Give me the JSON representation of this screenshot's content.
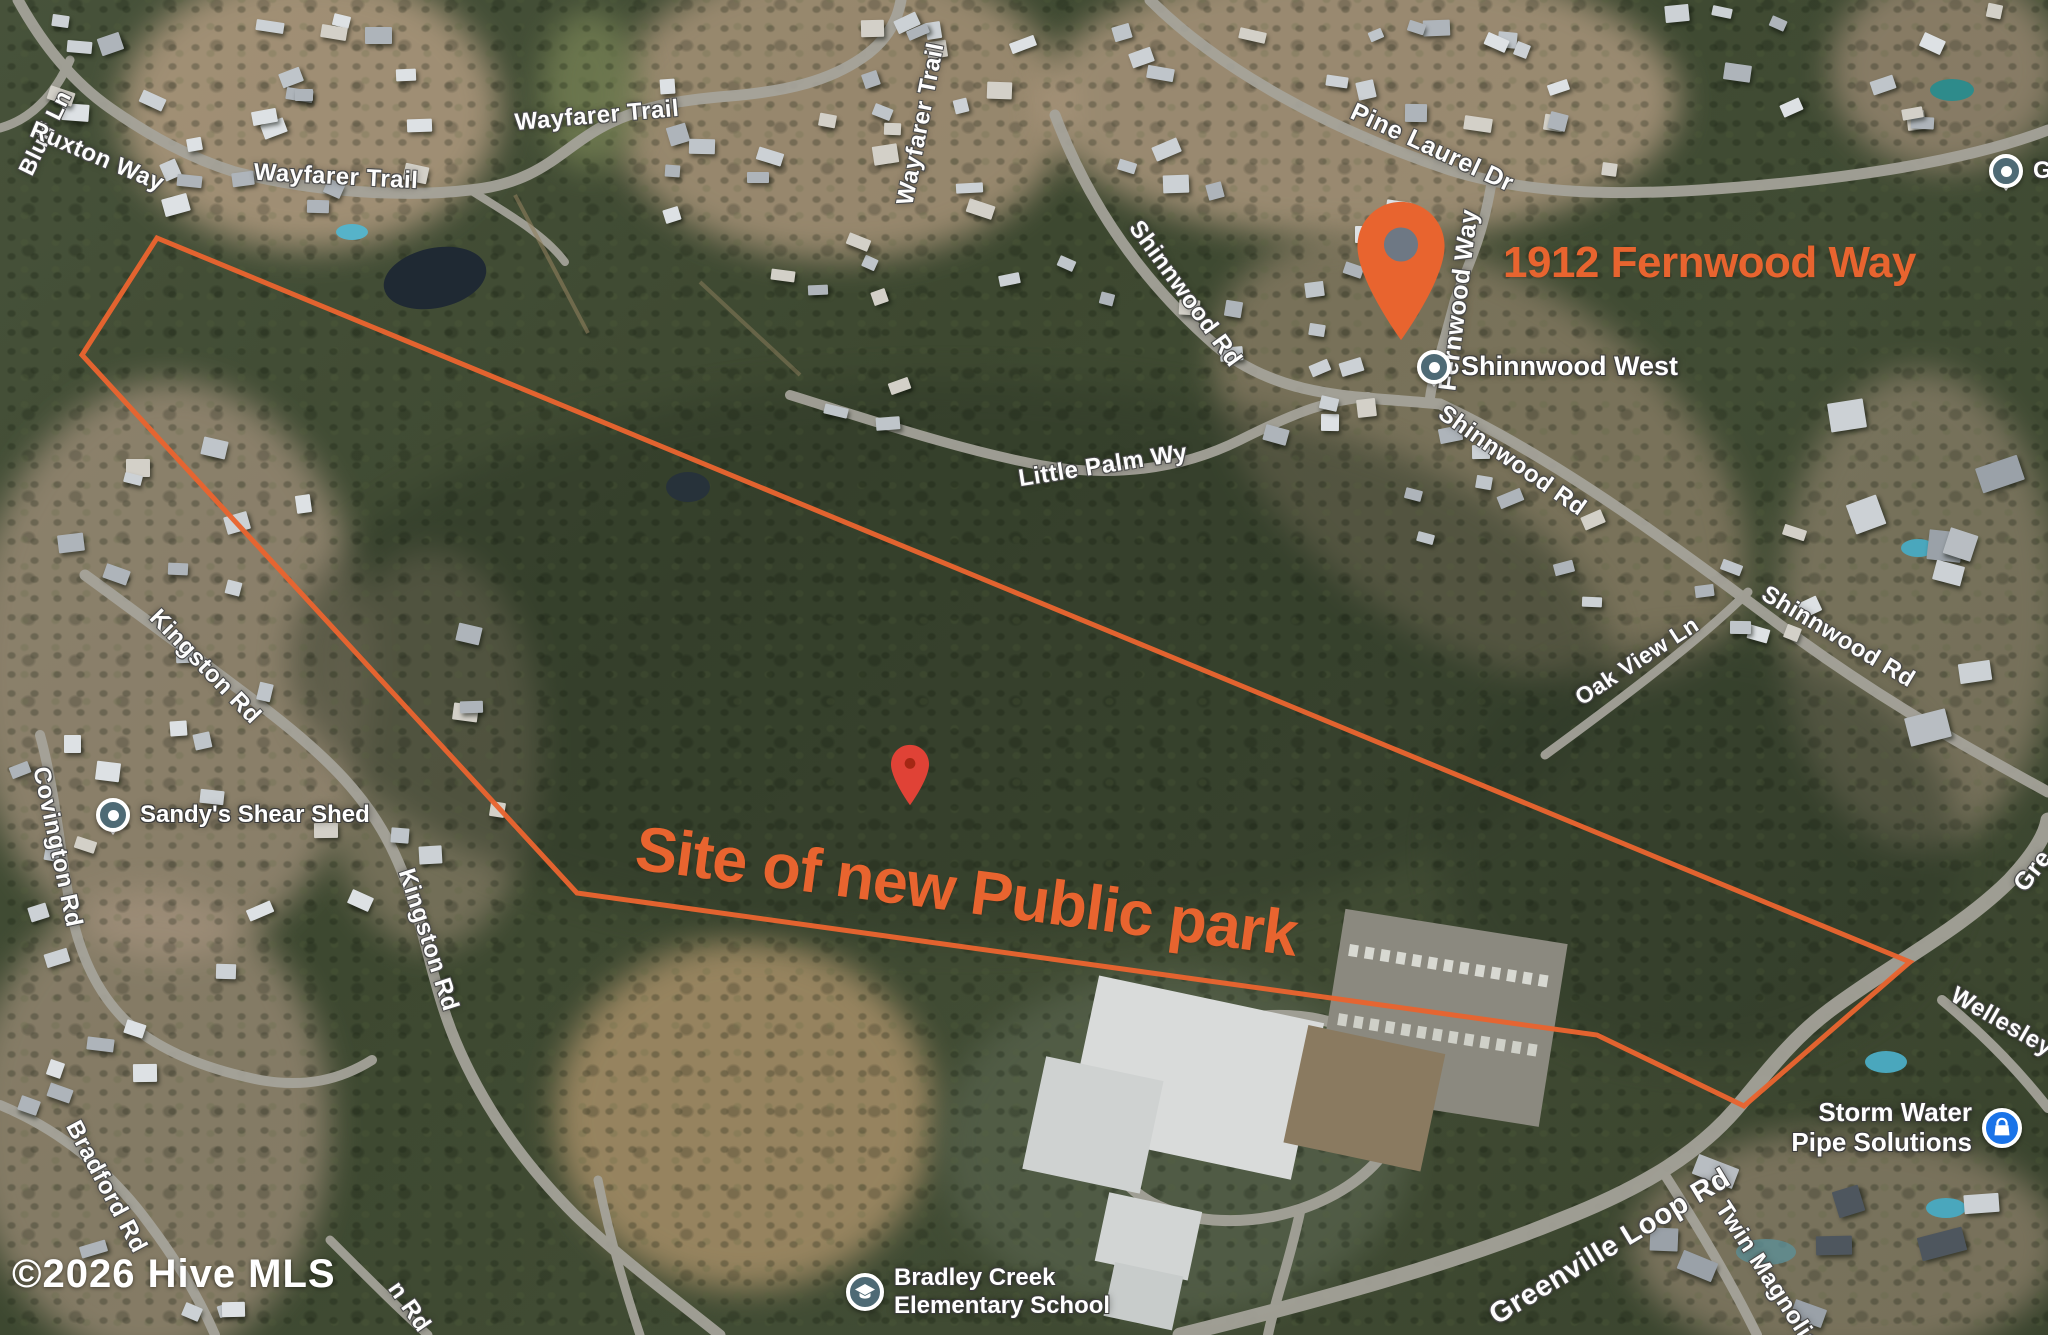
{
  "map": {
    "watermark": "©2026 Hive MLS",
    "annotations": {
      "site_label": "Site of new Public park",
      "address_label": "1912 Fernwood Way",
      "accent_color": "#e8642f"
    },
    "site_boundary": {
      "color": "#e8642f",
      "stroke_width": 5,
      "points": [
        [
          157,
          238
        ],
        [
          1910,
          962
        ],
        [
          1744,
          1106
        ],
        [
          1597,
          1035
        ],
        [
          577,
          893
        ],
        [
          82,
          355
        ]
      ]
    },
    "markers": [
      {
        "name": "address-pin",
        "color": "#e8642f",
        "hole_color": "#6e7884",
        "x": 1401,
        "y": 342,
        "w": 96,
        "h": 142
      },
      {
        "name": "small-red-pin",
        "color": "#e04236",
        "hole_color": "#a52714",
        "x": 910,
        "y": 806,
        "w": 48,
        "h": 62
      }
    ],
    "road_labels": [
      {
        "text": "Bluff Ln",
        "x": 45,
        "y": 133,
        "rot": -64,
        "size": 23
      },
      {
        "text": "Ruxton Way",
        "x": 97,
        "y": 157,
        "rot": 23,
        "size": 24
      },
      {
        "text": "Wayfarer Trail",
        "x": 336,
        "y": 177,
        "rot": 3,
        "size": 24
      },
      {
        "text": "Wayfarer Trail",
        "x": 597,
        "y": 116,
        "rot": -5,
        "size": 24
      },
      {
        "text": "Wayfarer Trail",
        "x": 921,
        "y": 124,
        "rot": -79,
        "size": 24
      },
      {
        "text": "Pine Laurel Dr",
        "x": 1432,
        "y": 148,
        "rot": 25,
        "size": 25
      },
      {
        "text": "Fernwood Way",
        "x": 1459,
        "y": 300,
        "rot": -83,
        "size": 25
      },
      {
        "text": "Shinnwood Rd",
        "x": 1185,
        "y": 294,
        "rot": 54,
        "size": 24
      },
      {
        "text": "Shinnwood Rd",
        "x": 1512,
        "y": 461,
        "rot": 35,
        "size": 24
      },
      {
        "text": "Shinnwood Rd",
        "x": 1838,
        "y": 637,
        "rot": 31,
        "size": 24
      },
      {
        "text": "Little Palm Wy",
        "x": 1103,
        "y": 466,
        "rot": -9,
        "size": 24
      },
      {
        "text": "Oak View Ln",
        "x": 1637,
        "y": 661,
        "rot": -33,
        "size": 23
      },
      {
        "text": "Kingston Rd",
        "x": 205,
        "y": 667,
        "rot": 46,
        "size": 24
      },
      {
        "text": "Kingston Rd",
        "x": 428,
        "y": 940,
        "rot": 72,
        "size": 24
      },
      {
        "text": "Covington Rd",
        "x": 57,
        "y": 847,
        "rot": 78,
        "size": 24
      },
      {
        "text": "Bradford Rd",
        "x": 106,
        "y": 1187,
        "rot": 62,
        "size": 24
      },
      {
        "text": "n Rd",
        "x": 409,
        "y": 1307,
        "rot": 55,
        "size": 24
      },
      {
        "text": "Greenville Loop Rd",
        "x": 1610,
        "y": 1247,
        "rot": -31,
        "size": 29
      },
      {
        "text": "Twin Magnolias Ln",
        "x": 1781,
        "y": 1297,
        "rot": 57,
        "size": 24
      },
      {
        "text": "Wellesley P",
        "x": 2012,
        "y": 1028,
        "rot": 30,
        "size": 24
      },
      {
        "text": "Gre",
        "x": 2033,
        "y": 871,
        "rot": -52,
        "size": 25
      }
    ],
    "pois": [
      {
        "name": "shinnwood-west",
        "label_lines": [
          "Shinnwood West"
        ],
        "icon": "circle-pin-icon",
        "icon_color": "#4e6a75",
        "x": 1434,
        "y": 367,
        "label_side": "right",
        "size": 27
      },
      {
        "name": "sandys-shear-shed",
        "label_lines": [
          "Sandy's Shear Shed"
        ],
        "icon": "circle-pin-icon",
        "icon_color": "#4e6a75",
        "x": 113,
        "y": 815,
        "label_side": "right",
        "size": 24
      },
      {
        "name": "bradley-creek-elementary-school",
        "label_lines": [
          "Bradley Creek",
          "Elementary School"
        ],
        "icon": "school-icon",
        "icon_color": "#4e6a75",
        "x": 865,
        "y": 1292,
        "label_side": "right",
        "size": 24
      },
      {
        "name": "storm-water-pipe-solutions",
        "label_lines": [
          "Storm Water",
          "Pipe Solutions"
        ],
        "icon": "bag-icon",
        "icon_color": "#1a73e8",
        "x": 2002,
        "y": 1128,
        "label_side": "left",
        "size": 26
      },
      {
        "name": "unlabeled-poi",
        "label_lines": [
          "G"
        ],
        "icon": "circle-pin-icon",
        "icon_color": "#4e6a75",
        "x": 2006,
        "y": 171,
        "label_side": "right",
        "size": 24
      }
    ]
  }
}
